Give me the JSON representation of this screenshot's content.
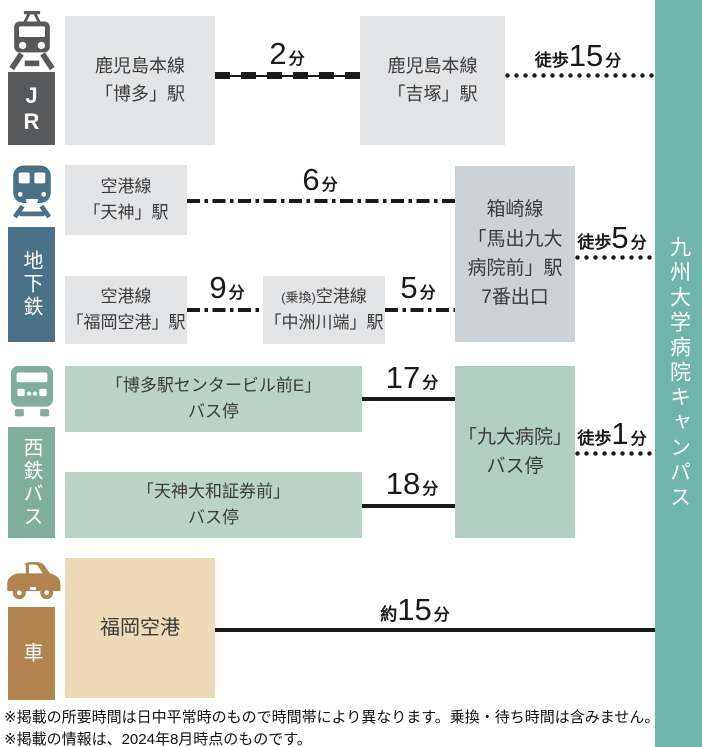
{
  "destination": {
    "label": "九州大学病院キャンパス",
    "color": "#6fb5ac"
  },
  "modes": {
    "jr": {
      "label": "J\nR",
      "color": "#58595b"
    },
    "subway": {
      "label": "地下鉄",
      "color": "#4a7187"
    },
    "bus": {
      "label": "西鉄バス",
      "color": "#7fae9c"
    },
    "car": {
      "label": "車",
      "color": "#b0834f"
    }
  },
  "stations": {
    "hakata": {
      "lines": [
        "鹿児島本線",
        "「博多」駅"
      ]
    },
    "yoshizuka": {
      "lines": [
        "鹿児島本線",
        "「吉塚」駅"
      ]
    },
    "tenjin": {
      "lines": [
        "空港線",
        "「天神」駅"
      ]
    },
    "fukuoka_airport_sta": {
      "lines": [
        "空港線",
        "「福岡空港」駅"
      ]
    },
    "nakasu": {
      "note": "(乗換)",
      "lines": [
        "空港線",
        "「中洲川端」駅"
      ]
    },
    "maidashi": {
      "lines": [
        "箱崎線",
        "「馬出九大",
        "病院前」駅",
        "7番出口"
      ]
    },
    "hakata_bus": {
      "lines": [
        "「博多駅センタービル前E」",
        "バス停"
      ]
    },
    "tenjin_bus": {
      "lines": [
        "「天神大和証券前」",
        "バス停"
      ]
    },
    "kyudai_bus": {
      "lines": [
        "「九大病院」",
        "バス停"
      ]
    },
    "fukuoka_airport": {
      "lines": [
        "福岡空港"
      ]
    }
  },
  "durations": {
    "jr_ride": {
      "prefix": "",
      "value": "2",
      "unit": "分"
    },
    "jr_walk": {
      "prefix": "徒歩",
      "value": "15",
      "unit": "分"
    },
    "subway_tenjin": {
      "prefix": "",
      "value": "6",
      "unit": "分"
    },
    "subway_airport": {
      "prefix": "",
      "value": "9",
      "unit": "分"
    },
    "subway_nakasu": {
      "prefix": "",
      "value": "5",
      "unit": "分"
    },
    "subway_walk": {
      "prefix": "徒歩",
      "value": "5",
      "unit": "分"
    },
    "bus_hakata": {
      "prefix": "",
      "value": "17",
      "unit": "分"
    },
    "bus_tenjin": {
      "prefix": "",
      "value": "18",
      "unit": "分"
    },
    "bus_walk": {
      "prefix": "徒歩",
      "value": "1",
      "unit": "分"
    },
    "car_drive": {
      "prefix": "約",
      "value": "15",
      "unit": "分"
    }
  },
  "footnotes": {
    "line1": "※掲載の所要時間は日中平常時のもので時間帯により異なります。乗換・待ち時間は含みません。",
    "line2": "※掲載の情報は、2024年8月時点のものです。"
  }
}
